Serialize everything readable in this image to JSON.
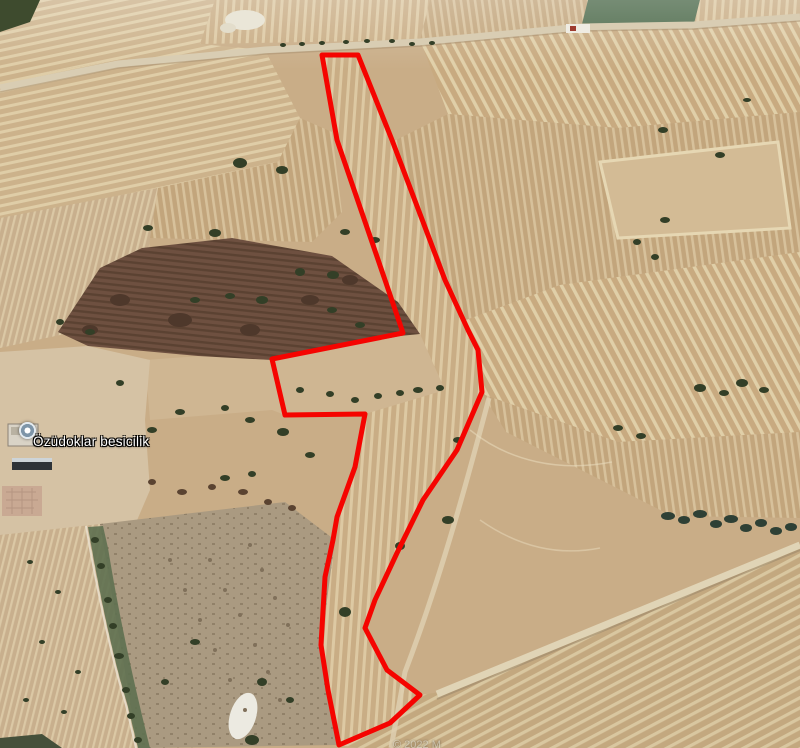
{
  "view": {
    "type": "oblique-satellite-imagery",
    "description": "Aerial view of harvested farmland with a red land-parcel boundary overlay"
  },
  "poi": {
    "label": "Özüdoklar besicilik"
  },
  "attribution": {
    "text": "© 2022 M"
  },
  "parcel": {
    "points": "322,55 358,55 392,140 445,280 468,330 478,350 482,392 457,450 423,500 397,553 375,600 365,628 387,670 420,695 390,723 339,745 328,690 321,645 325,577 333,540 337,517 355,467 365,414 285,415 272,359 403,333 385,280 337,140",
    "stroke": "#f50400",
    "stroke_width": 5
  },
  "palette": {
    "field_tan": "#c9ad87",
    "stripe_light": "#ddc9a3",
    "dark_plowed_soil": "#6e5040",
    "tree_green": "#333f27",
    "road": "#d9cdb3",
    "scrub_grey": "#aa9a81"
  }
}
